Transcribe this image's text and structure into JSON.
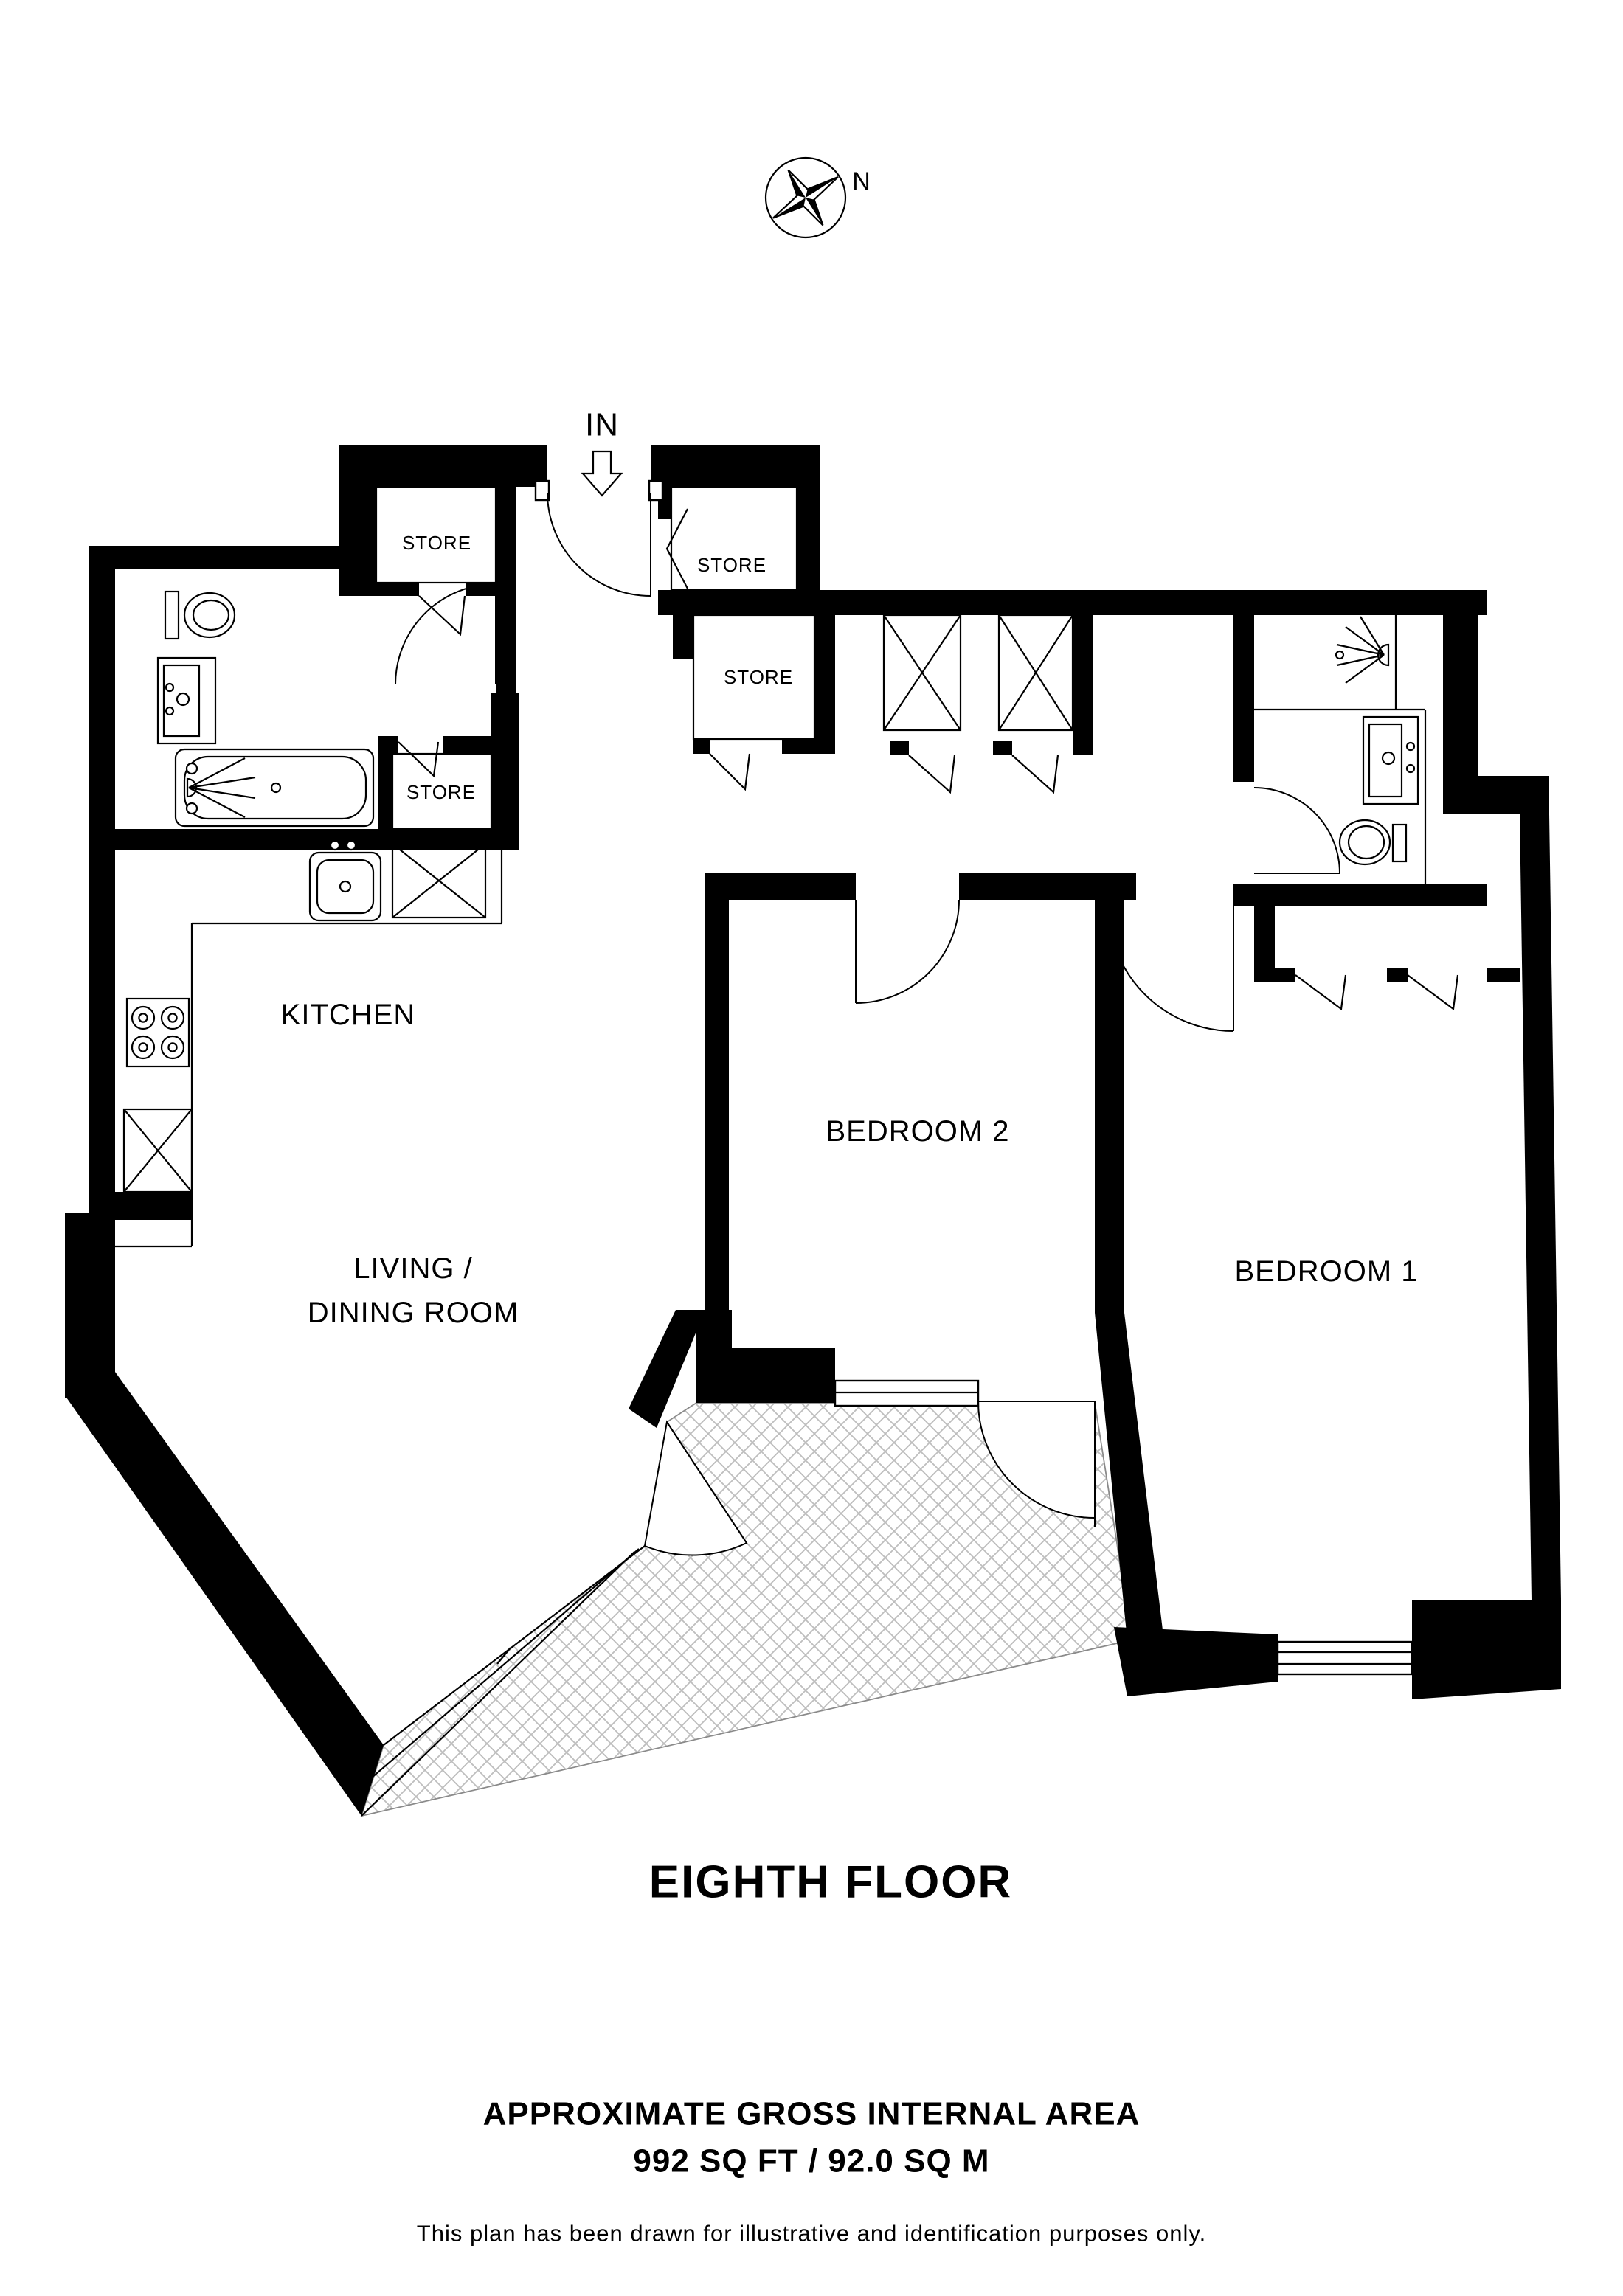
{
  "compass": {
    "north_label": "N"
  },
  "entrance": {
    "label": "IN"
  },
  "rooms": {
    "kitchen": {
      "label": "KITCHEN"
    },
    "living_dining": {
      "line1": "LIVING /",
      "line2": "DINING ROOM"
    },
    "bedroom2": {
      "label": "BEDROOM 2"
    },
    "bedroom1": {
      "label": "BEDROOM 1"
    }
  },
  "stores": [
    "STORE",
    "STORE",
    "STORE",
    "STORE"
  ],
  "title": {
    "floor_label": "EIGHTH FLOOR"
  },
  "footer": {
    "area_heading": "APPROXIMATE GROSS INTERNAL AREA",
    "area_value": "992 SQ FT / 92.0 SQ M",
    "disclaimer": "This plan has been drawn for illustrative and identification purposes only."
  },
  "colors": {
    "wall": "#000000",
    "hatch_line": "#bdbdbd",
    "background": "#ffffff"
  }
}
